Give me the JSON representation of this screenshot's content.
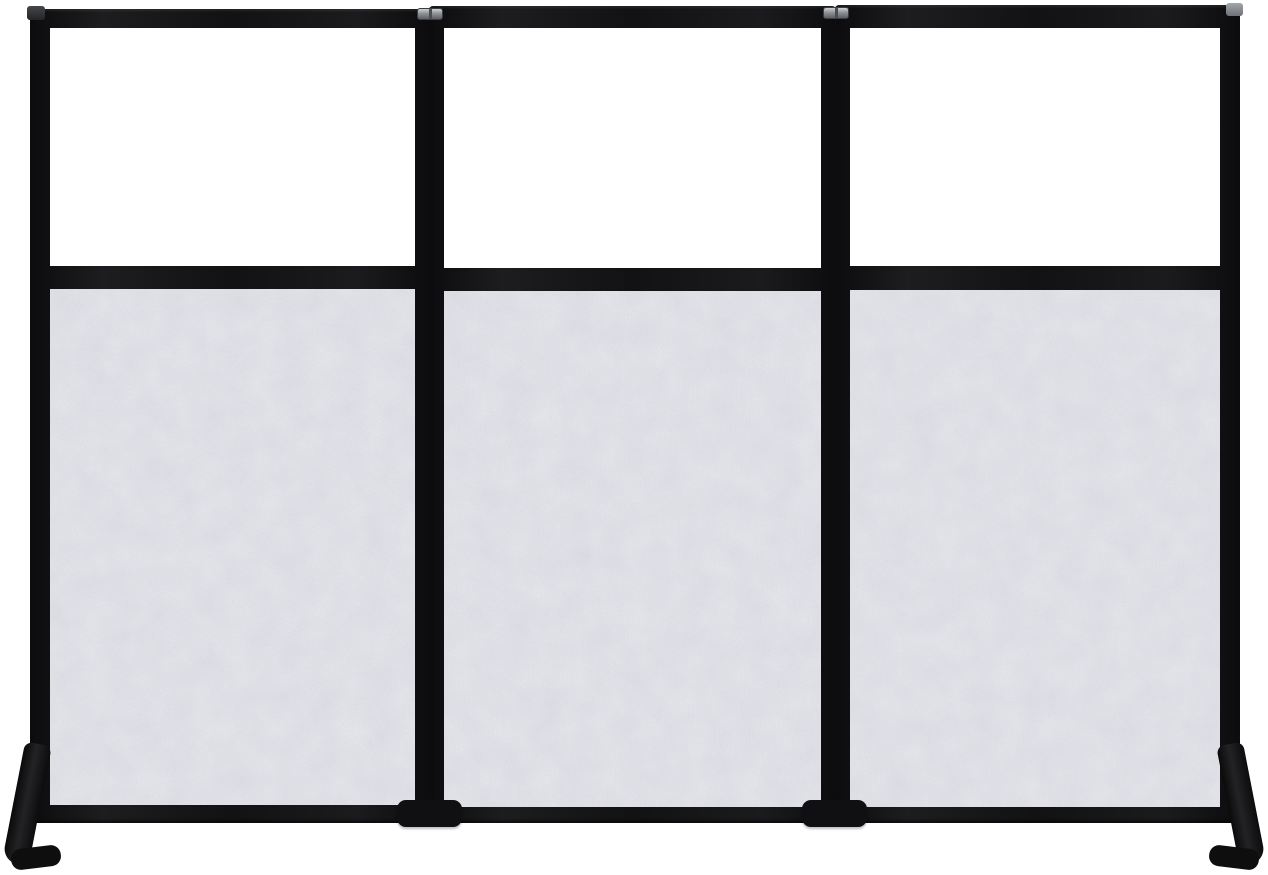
{
  "meta": {
    "content_type": "product-photo",
    "subject": "Freestanding three-panel folding room divider / office partition wall",
    "background_color": "#ffffff"
  },
  "palette": {
    "frame_black": "#121214",
    "felt_base": "#dfe0e6",
    "felt_speckle": "#8f93a1",
    "felt_cloud": "#e9eaef",
    "window_white": "#ffffff",
    "hinge_gray": "#8e9196",
    "foot_black": "#0e0e0f"
  },
  "structure": {
    "panel_count": 3,
    "panels": [
      {
        "id": "left-panel",
        "upper_section": "clear window",
        "lower_section": "gray speckled acoustic felt"
      },
      {
        "id": "center-panel",
        "upper_section": "clear window",
        "lower_section": "gray speckled acoustic felt"
      },
      {
        "id": "right-panel",
        "upper_section": "clear window",
        "lower_section": "gray speckled acoustic felt"
      }
    ],
    "hinges_visible": 2,
    "feet": [
      "angled outer foot lower-left",
      "block foot under left junction",
      "block foot under right junction",
      "angled outer foot lower-right"
    ]
  }
}
